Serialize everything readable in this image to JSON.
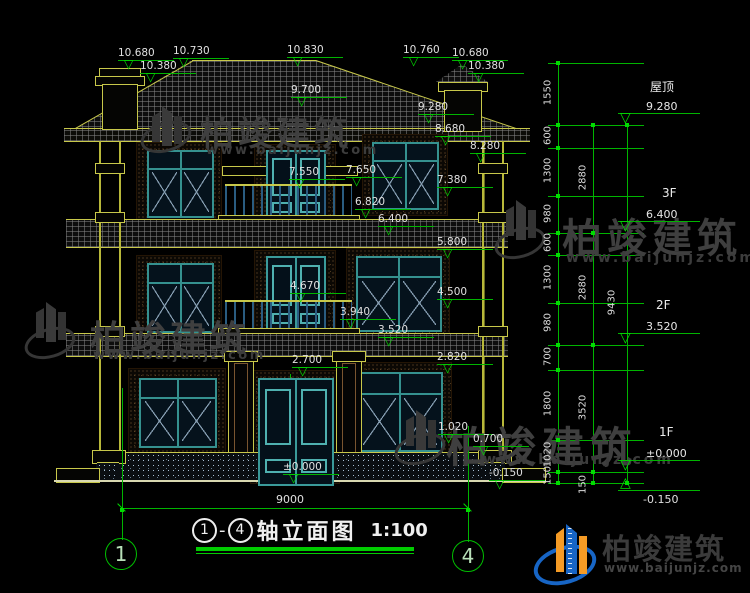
{
  "brand": {
    "name": "柏竣建筑",
    "url": "www.baijunjz.com"
  },
  "title": {
    "axis_from": "1",
    "separator": "-",
    "axis_to": "4",
    "name": "轴立面图",
    "scale": "1:100"
  },
  "axis_bubbles": {
    "left": "1",
    "right": "4"
  },
  "overall_width": "9000",
  "floors": [
    {
      "label": "屋顶",
      "value": "9.280"
    },
    {
      "label": "3F",
      "value": "6.400"
    },
    {
      "label": "2F",
      "value": "3.520"
    },
    {
      "label": "1F",
      "value": "±0.000"
    },
    {
      "label": "",
      "value": "-0.150"
    }
  ],
  "elevations": [
    "10.680",
    "10.380",
    "10.730",
    "10.830",
    "9.700",
    "10.760",
    "10.680",
    "10.380",
    "9.280",
    "8.680",
    "8.280",
    "7.550",
    "7.650",
    "7.380",
    "6.820",
    "6.400",
    "5.800",
    "4.670",
    "4.500",
    "3.940",
    "3.520",
    "2.700",
    "2.820",
    "1.020",
    "0.700",
    "±0.000",
    "-0.150"
  ],
  "dims": {
    "col1": [
      "1550",
      "600",
      "1300",
      "980",
      "600",
      "1300",
      "980",
      "700",
      "1800",
      "1020",
      "150"
    ],
    "col2": [
      "2880",
      "2880",
      "3520",
      "150"
    ],
    "col3": [
      "9430"
    ]
  },
  "colors": {
    "dim_green": "#00b400",
    "line_yellow": "#c8c84a",
    "frame_teal": "#35918f",
    "logo_blue": "#1765c5",
    "logo_orange": "#f59b25"
  }
}
